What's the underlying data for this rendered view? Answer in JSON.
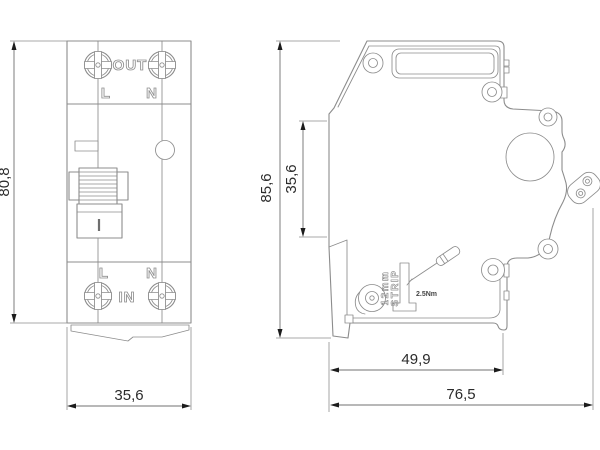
{
  "front_view": {
    "terminal_top_label": "OUT",
    "terminal_bottom_label": "IN",
    "line_top_label": "L",
    "neutral_top_label": "N",
    "line_bottom_label": "L",
    "neutral_bottom_label": "N",
    "dim_height": "80,8",
    "dim_width": "35,6"
  },
  "side_view": {
    "dim_height_overall": "85,6",
    "dim_height_front": "35,6",
    "dim_depth_body": "49,9",
    "dim_depth_overall": "76,5",
    "strip_marking_line1": "12mm",
    "strip_marking_line2": "STRIP",
    "torque_marking": "2.5Nm"
  },
  "colors": {
    "line": "#8c8c8c",
    "dimension_text": "#2b2b2b",
    "background": "#ffffff"
  }
}
